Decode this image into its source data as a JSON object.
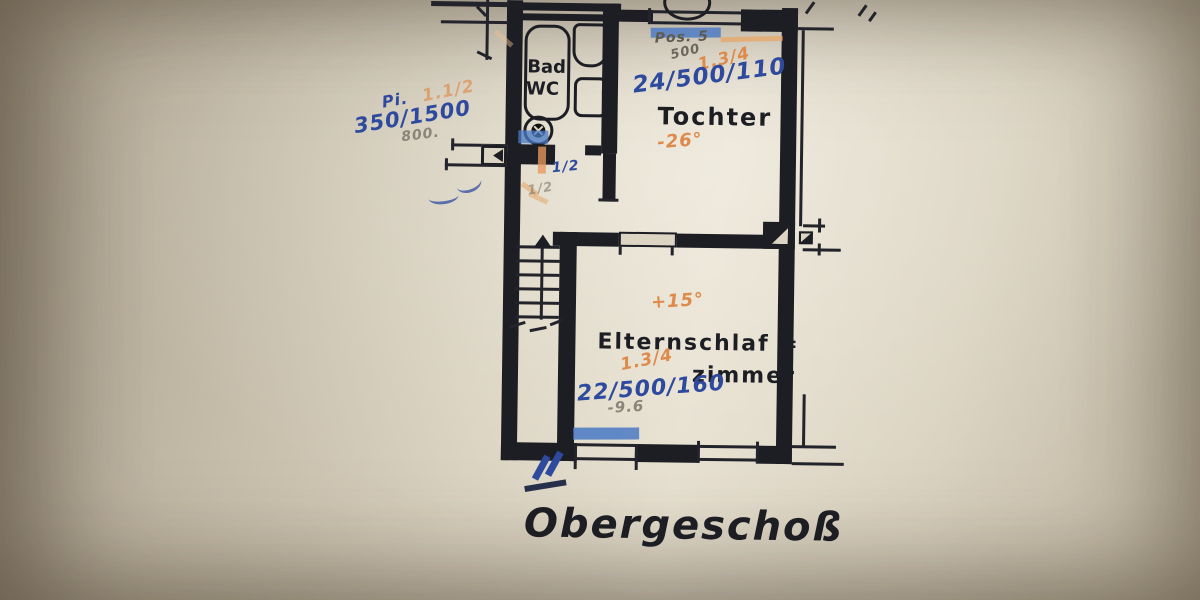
{
  "title": {
    "label": "Obergeschoß"
  },
  "rooms": {
    "bath": {
      "line1": "Bad",
      "line2": "WC"
    },
    "tochter": {
      "name": "Tochter"
    },
    "eltern": {
      "line1": "Elternschlaf =",
      "line2": "zimmer"
    }
  },
  "annotations": {
    "left_orange_ratio": "1.1/2",
    "left_blue_prefix": "Pi.",
    "left_blue_dim": "350/1500",
    "left_pencil": "800.",
    "top_pencil_pos": "Pos. 5",
    "top_pencil_500": "500",
    "tochter_orange_ratio": "1.3/4",
    "tochter_blue_dim": "24/500/110",
    "tochter_orange_temp": "-26°",
    "eltern_orange_temp": "+15°",
    "eltern_orange_ratio": "1.3/4",
    "eltern_blue_dim": "22/500/160",
    "eltern_pencil": "-9.6",
    "hall_blue_half": "1/2",
    "hall_pencil_half": "1/2"
  },
  "colors": {
    "ink_blue": "#2e4a9e",
    "ink_orange": "#dd8a4a",
    "pencil_gray": "#8a8578",
    "line_black": "#1d1d24",
    "highlight_blue": "#4a79c4",
    "paper": "#ddd5c3"
  }
}
